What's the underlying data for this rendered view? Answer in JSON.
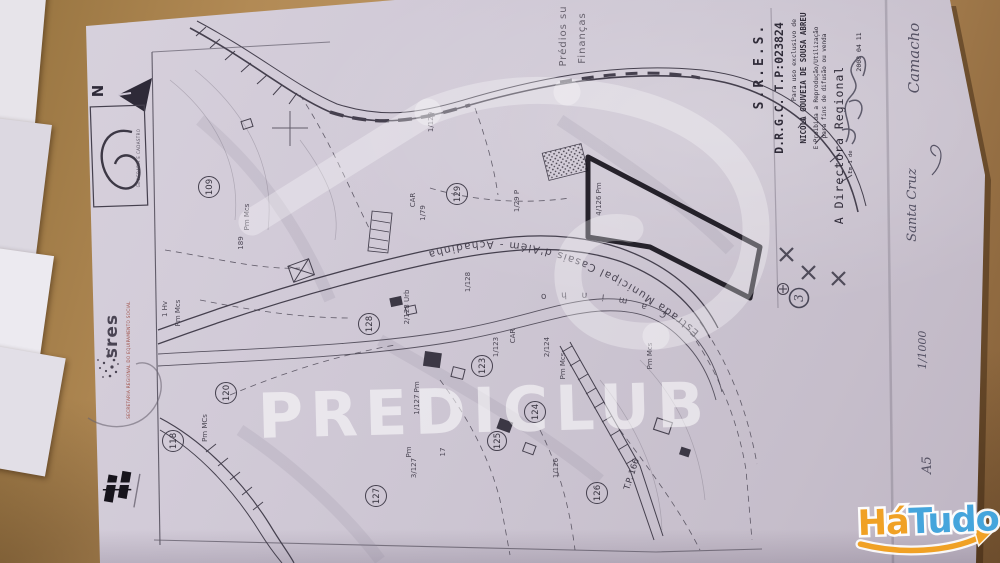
{
  "watermark": {
    "text": "PREDICLUB"
  },
  "hatudo_logo": {
    "word1": "Há",
    "word2": "Tudo",
    "orange": "#f0a125",
    "blue": "#45a5dc"
  },
  "stamp": {
    "line1": "Prédios su",
    "line2": "Finanças"
  },
  "legend": {
    "org": "S.R.E.S.",
    "reference": "D.R.G.C.  T.P:023824",
    "usage": "Para uso exclusivo de",
    "name": "NICOLA GOUVEIA DE SOUSA ABREU",
    "prohibition_1": "E Proibida a Reprodução/Utilização",
    "prohibition_2": "para fins de difusão ou venda",
    "signatory": "A Directora Regional",
    "date": "2008 04 11",
    "date_note": "Em 1 de"
  },
  "compass": {
    "north": "N"
  },
  "agency_box": {
    "caption": "GEOGRAFIA E CADASTRO"
  },
  "sres": {
    "logo": "sres",
    "tagline": "SECRETARIA REGIONAL DO EQUIPAMENTO SOCIAL"
  },
  "map": {
    "road_main": "Estrada Municipal Casais d'Além - Achadinha",
    "road_secondary": "C a m i n h o",
    "road_code": "T.P. 166",
    "parcels": [
      "109",
      "129",
      "128",
      "120",
      "118",
      "123",
      "124",
      "125",
      "126",
      "127"
    ],
    "fractions": [
      "1/129",
      "1/79",
      "CAR",
      "1/29 P",
      "4/126 Pm",
      "Pm Mcs",
      "189",
      "1 Hv",
      "Pm Mcs",
      "1/128",
      "2/128 Urb",
      "1/123",
      "CAR",
      "2/124",
      "Pm Mcs",
      "1/127 Pm",
      "3/127",
      "Pm",
      "17",
      "1/126",
      "Pm MCs",
      "Pm Mcs"
    ],
    "handwritten_circle": "3"
  },
  "handwriting": {
    "note_top": "Camacho",
    "note_place": "Santa Cruz",
    "scale": "1/1000",
    "sheet": "A5"
  }
}
